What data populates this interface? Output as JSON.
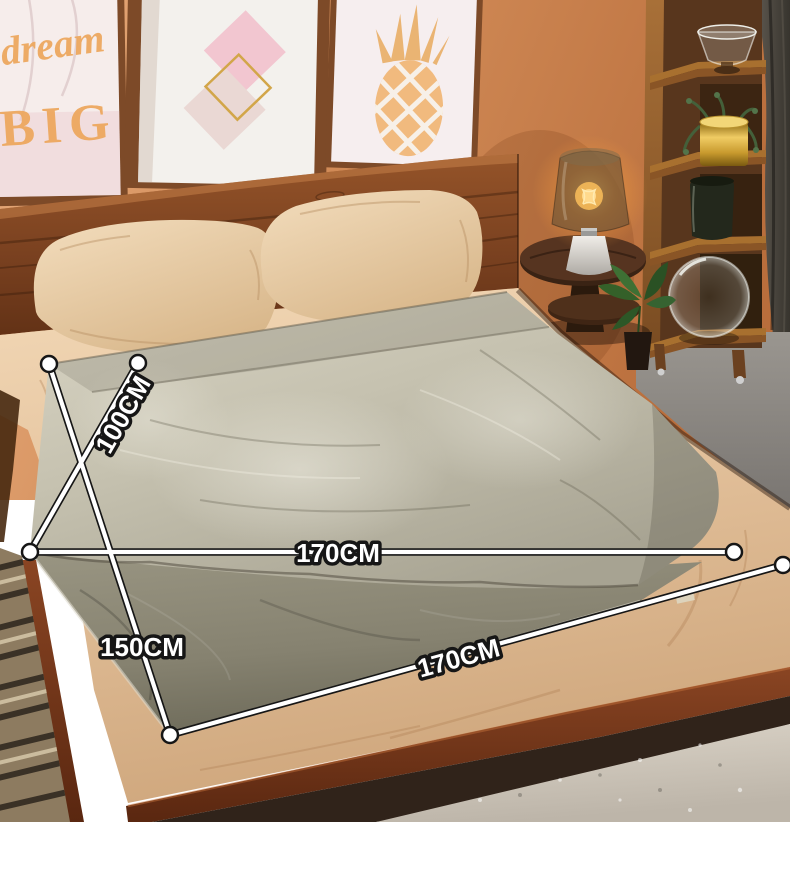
{
  "photo": {
    "description": "Bedroom product photo: two velvet blankets spread on a double bed with size measurement annotation lines"
  },
  "wall_art": {
    "left_frame": {
      "line1": "dream",
      "line2": "BIG"
    }
  },
  "measurements": {
    "labels": [
      {
        "name": "top-blanket-width",
        "text": "100CM"
      },
      {
        "name": "top-blanket-length",
        "text": "170CM"
      },
      {
        "name": "under-blanket-width",
        "text": "150CM"
      },
      {
        "name": "under-blanket-length",
        "text": "170CM"
      }
    ]
  },
  "palette": {
    "measure_line": "#ffffff",
    "measure_outline": "#161616",
    "wall": "#d08a57",
    "headboard_wood": "#7d4424",
    "pillow": "#eed6b4",
    "sheet": "#e7c7a3",
    "top_blanket": "#c6c2b0",
    "under_blanket": "#8a8675",
    "art_text_orange": "#eda85f",
    "frame_wood": "#7d4a28",
    "gold_accent": "#d9a84e",
    "curtain": "#44403a",
    "floor_carpet": "#8b8781",
    "area_rug": "#cfc8bc"
  }
}
